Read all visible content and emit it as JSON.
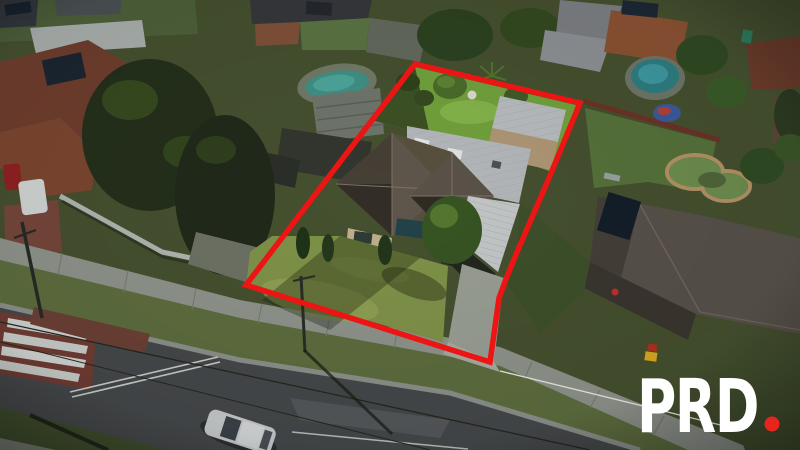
{
  "photo": {
    "type": "aerial-drone-photograph",
    "description": "Top-down aerial view of a suburban residential property outlined with a red boundary polygon, surrounded by neighbouring houses, pools, trees, a road with a pedestrian crossing and a parked car"
  },
  "boundary": {
    "points": "415,64 580,103 549,178 517,252 506,279 499,298 490,362 246,285",
    "color": "#ed1414",
    "stroke_width": "5.5"
  },
  "brand": {
    "name": "PRD"
  },
  "colors": {
    "boundary-red": "#ed1414",
    "logo-white": "#ffffff",
    "logo-dot-red": "#e8251d"
  }
}
